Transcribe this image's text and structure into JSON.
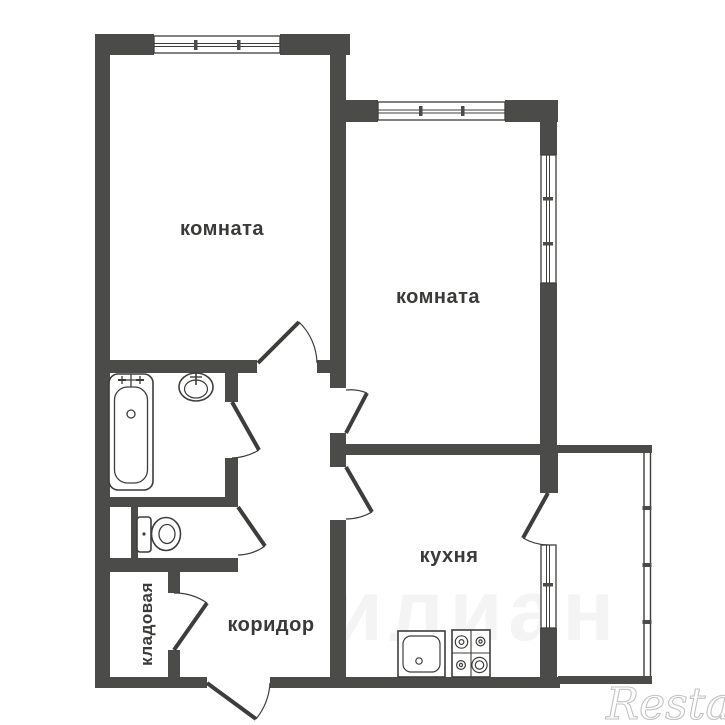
{
  "plan": {
    "type": "apartment-floor-plan",
    "labels": {
      "room1": "комната",
      "room2": "комната",
      "kitchen": "кухня",
      "corridor": "коридор",
      "storage": "кладовая"
    },
    "fixtures": [
      "bathtub",
      "wash-basin",
      "toilet",
      "kitchen-sink",
      "stove-4-burner"
    ],
    "windows": [
      "room1-top-window",
      "room2-top-window",
      "room2-right-window",
      "kitchen-window",
      "balcony-glazing"
    ],
    "doors": [
      "room1-door",
      "room2-door",
      "kitchen-door",
      "bathroom-door",
      "toilet-door",
      "storage-door",
      "entrance-door",
      "balcony-door"
    ],
    "colors": {
      "wall": "#4b4b49",
      "line": "#3d3d3b",
      "label": "#3a3a38",
      "background": "#ffffff",
      "watermark": "#c3c3c3"
    }
  },
  "watermarks": {
    "restate": "Restate",
    "faint": "илиан"
  }
}
